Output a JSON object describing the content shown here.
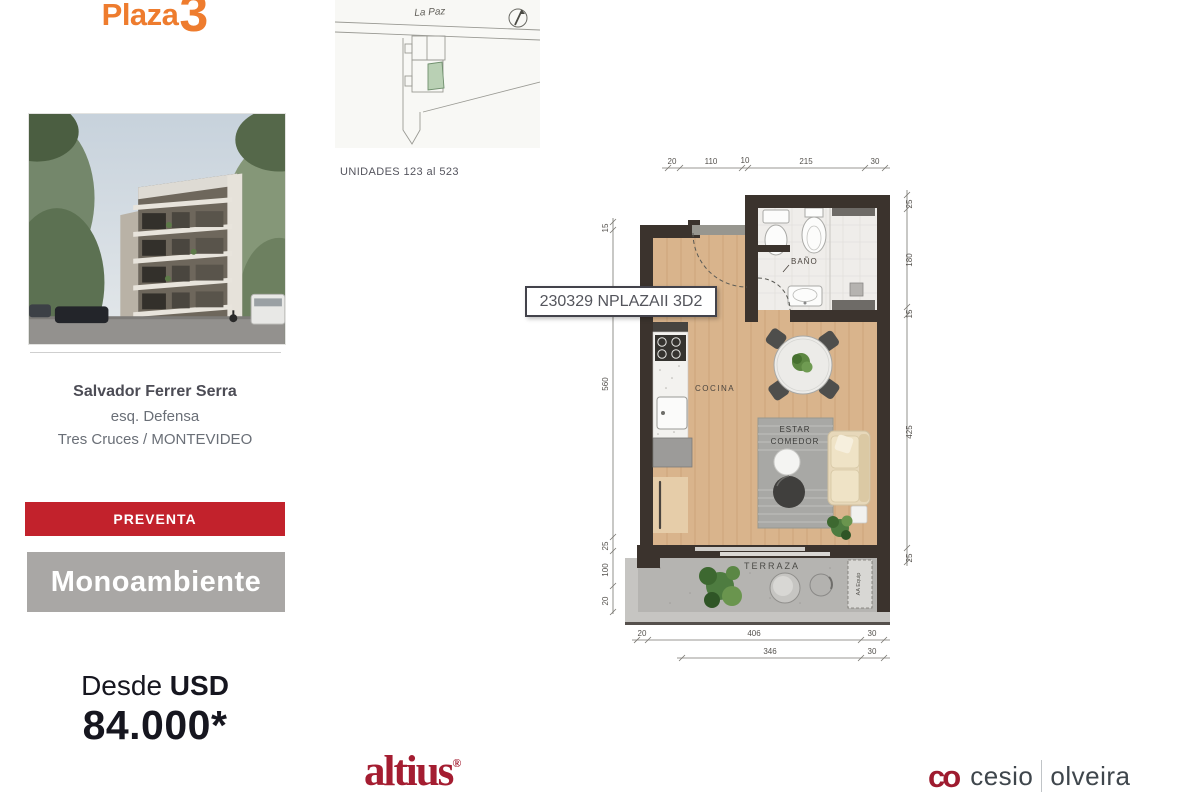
{
  "brand": {
    "logo_text": "Plaza",
    "logo_number": "3"
  },
  "listing": {
    "address_line1": "Salvador Ferrer Serra",
    "address_line2": "esq. Defensa",
    "address_line3": "Tres Cruces / MONTEVIDEO",
    "status_badge": "PREVENTA",
    "unit_type": "Monoambiente",
    "price_prefix": "Desde",
    "price_currency": "USD",
    "price_amount": "84.000*"
  },
  "site_plan": {
    "street_label": "La Paz",
    "units_caption": "UNIDADES 123 al 523"
  },
  "floor_plan": {
    "tooltip": "230329 NPLAZAII 3D2",
    "room_bath": "BAÑO",
    "room_kitchen": "COCINA",
    "room_living_line1": "ESTAR",
    "room_living_line2": "COMEDOR",
    "room_terrace": "TERRAZA",
    "aa_equip": "AA Equip",
    "dim_top": [
      "20",
      "110",
      "10",
      "215",
      "30"
    ],
    "dim_left": [
      "15",
      "560",
      "25",
      "100",
      "20"
    ],
    "dim_right": [
      "25",
      "180",
      "15",
      "425",
      "25"
    ],
    "dim_bottom_outer": [
      "20",
      "406",
      "30"
    ],
    "dim_bottom_inner": [
      "346",
      "30"
    ]
  },
  "footer": {
    "brand_left": "altius",
    "brand_left_mark": "®",
    "brand_right_icon": "co",
    "brand_right_name1": "cesio",
    "brand_right_name2": "olveira"
  },
  "colors": {
    "brand_orange": "#ee7c2e",
    "badge_red": "#c2222c",
    "badge_gray": "#a9a7a5",
    "price_dark": "#16161f",
    "altius_red": "#a41d31",
    "cesio_red": "#9e1b2f",
    "unit_highlight_green": "#b9d0b4",
    "wall_dark": "#3b332d",
    "wood_floor": "#d9b48c"
  }
}
